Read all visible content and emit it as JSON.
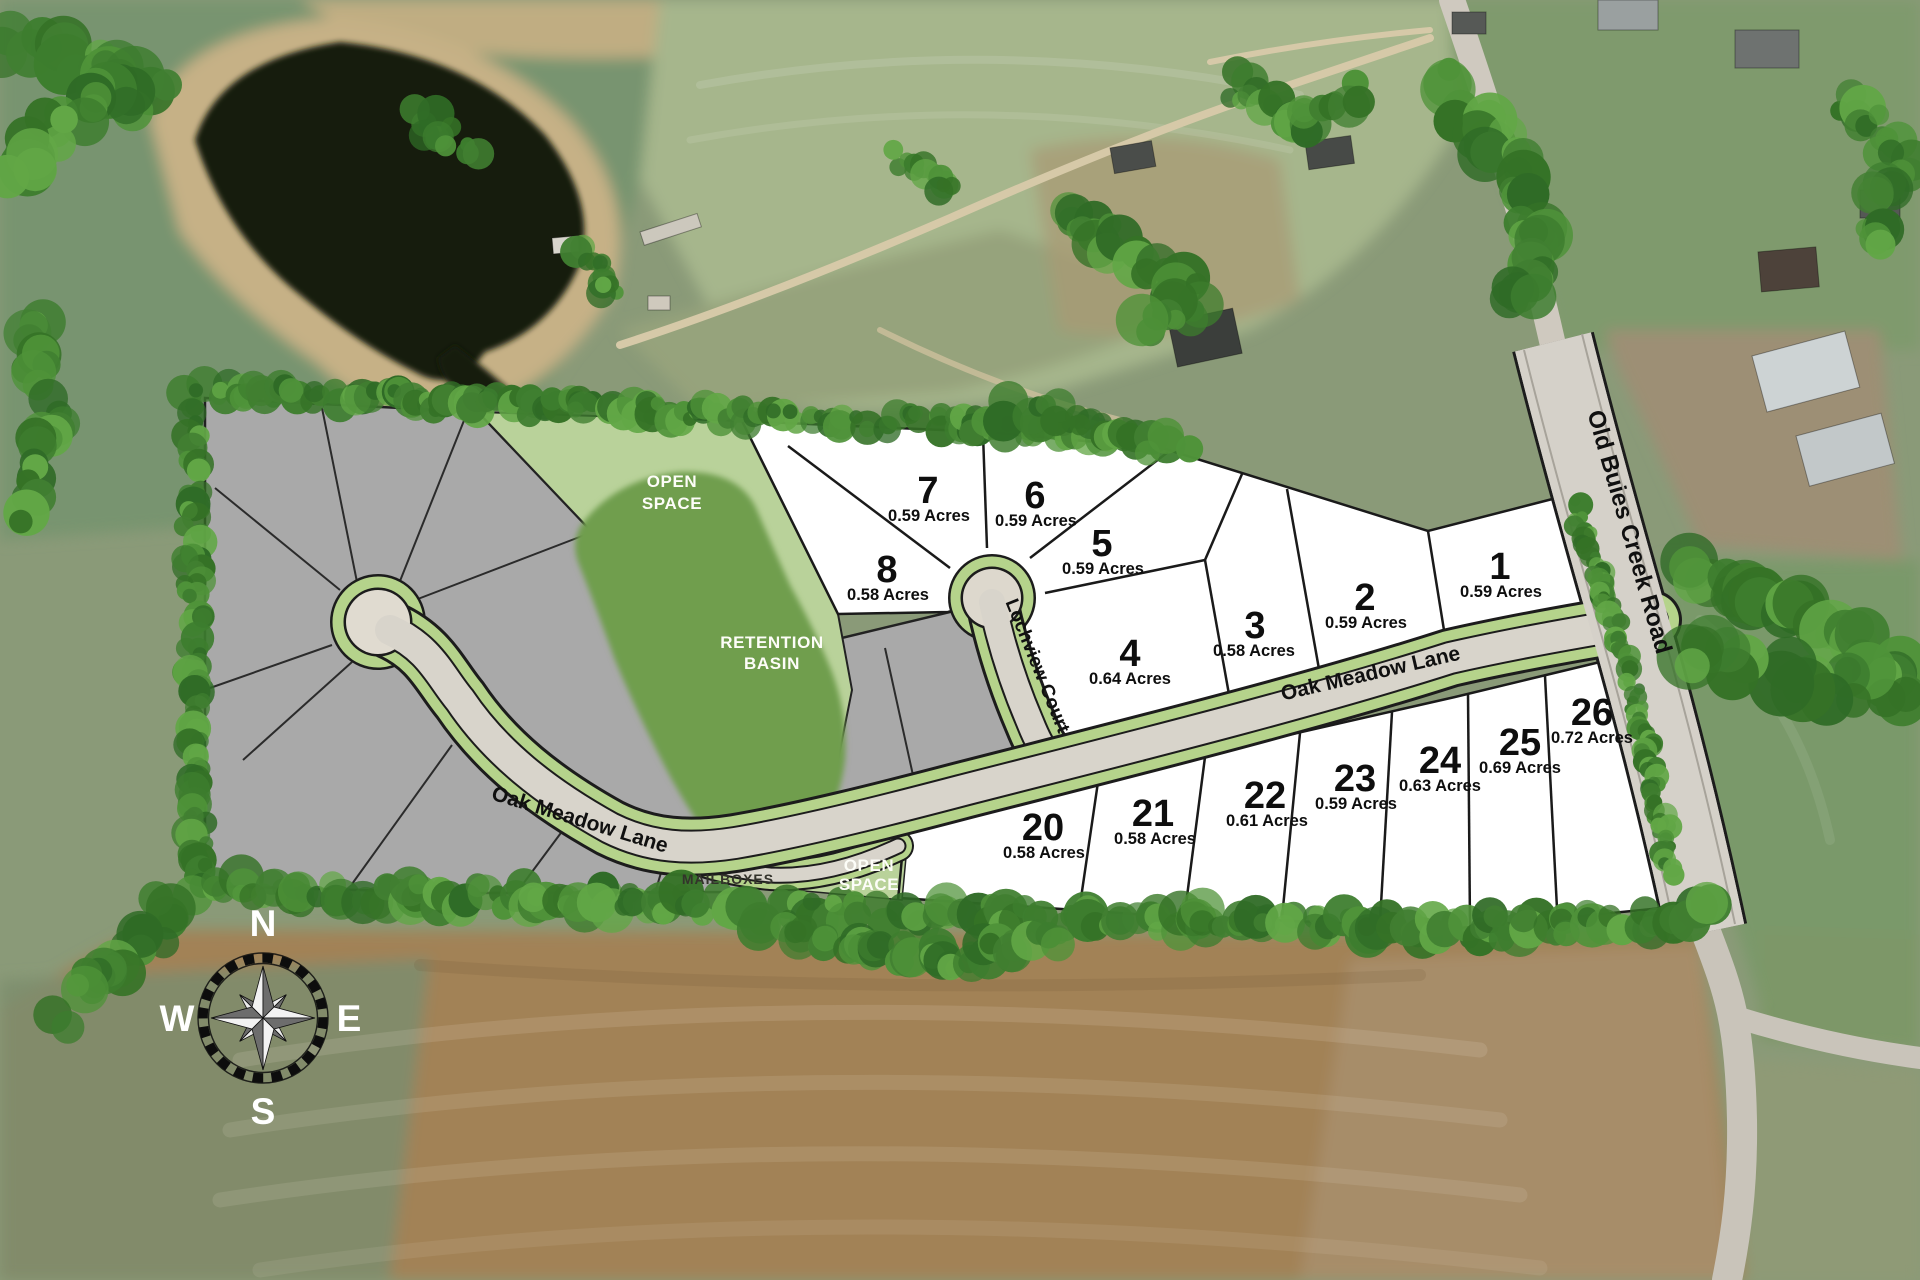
{
  "site_plan": {
    "lots": [
      {
        "number": "1",
        "acres": "0.59 Acres"
      },
      {
        "number": "2",
        "acres": "0.59 Acres"
      },
      {
        "number": "3",
        "acres": "0.58 Acres"
      },
      {
        "number": "4",
        "acres": "0.64 Acres"
      },
      {
        "number": "5",
        "acres": "0.59 Acres"
      },
      {
        "number": "6",
        "acres": "0.59 Acres"
      },
      {
        "number": "7",
        "acres": "0.59 Acres"
      },
      {
        "number": "8",
        "acres": "0.58 Acres"
      },
      {
        "number": "20",
        "acres": "0.58 Acres"
      },
      {
        "number": "21",
        "acres": "0.58 Acres"
      },
      {
        "number": "22",
        "acres": "0.61 Acres"
      },
      {
        "number": "23",
        "acres": "0.59 Acres"
      },
      {
        "number": "24",
        "acres": "0.63 Acres"
      },
      {
        "number": "25",
        "acres": "0.69 Acres"
      },
      {
        "number": "26",
        "acres": "0.72 Acres"
      }
    ],
    "roads": {
      "oak_meadow_lane": "Oak Meadow Lane",
      "lochview_court": "Lochview Court",
      "old_buies_creek_road": "Old Buies Creek Road"
    },
    "areas": {
      "open_space_line1": "OPEN",
      "open_space_line2": "SPACE",
      "retention_line1": "RETENTION",
      "retention_line2": "BASIN",
      "mailboxes": "MAILBOXES"
    },
    "compass": {
      "north": "N",
      "east": "E",
      "south": "S",
      "west": "W"
    },
    "colors": {
      "available_lot": "#ffffff",
      "future_lot": "#a9a9a9",
      "open_space": "#b9d29a",
      "retention_basin": "#6f9e4d",
      "road_verge": "#b5d38b",
      "pavement": "#d8d4cb",
      "road_shoulder": "#daa96c"
    }
  }
}
